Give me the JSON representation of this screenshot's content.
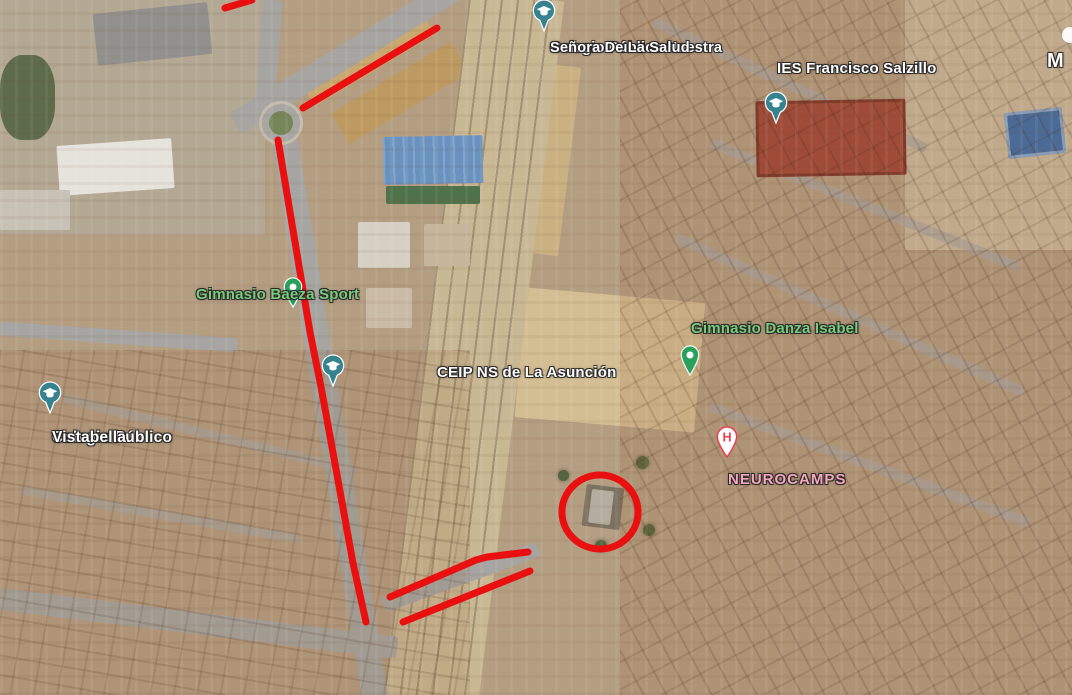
{
  "colors": {
    "annotation": "#ea1010",
    "label-white": "#ffffff",
    "label-green": "#79cc7d",
    "label-pink": "#f6a8c0",
    "pin-teal": "#37828f",
    "pin-green": "#28a15c",
    "pin-red": "#e8414f"
  },
  "places": {
    "salud": {
      "line1": "Colegio Público Nuestra",
      "line2": "Señora De La Salud"
    },
    "salzillo": {
      "line1": "IES Francisco Salzillo"
    },
    "baeza": {
      "line1": "Gimnasio Baeza Sport"
    },
    "danza": {
      "line1": "Gimnasio Danza Isabel"
    },
    "asuncion": {
      "line1": "CEIP NS de La Asunción"
    },
    "vistabella": {
      "line1": "Colegio Público",
      "line2": "Vistabella"
    },
    "neurocamps": {
      "line1": "NEUROCAMPS"
    },
    "partial_m": {
      "line1": "M"
    }
  },
  "pins": {
    "hospital_letter": "H"
  },
  "annotations": {
    "main_route": {
      "points": "278,140 310,332 322,392 353,563 366,622"
    },
    "top_diagonal": {
      "points": "437,28 303,108"
    },
    "top_corner": {
      "points": "252,0 225,8"
    },
    "parking_upper": {
      "points": "390,597 476,560 487,557 528,552"
    },
    "parking_lower": {
      "points": "403,622 530,571"
    },
    "highlight_circle": {
      "d": "M 562 512 a 38 37 0 1 0 76 0 a 38 37 0 1 0 -76 0"
    }
  }
}
